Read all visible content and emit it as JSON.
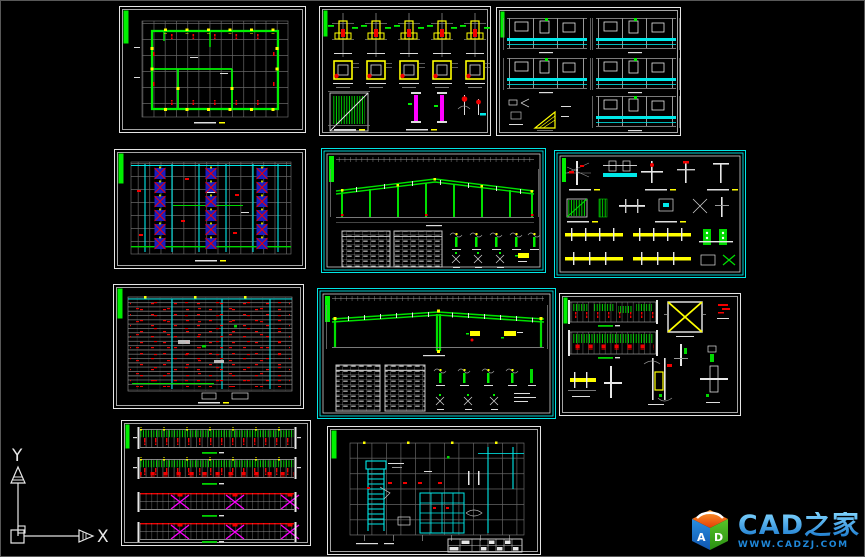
{
  "window": {
    "background": "#000000",
    "edge_border": "#585858"
  },
  "palette": {
    "green": "#00f000",
    "cyan": "#00e8e8",
    "red": "#f20000",
    "yellow": "#ffff00",
    "magenta": "#ff00ff",
    "blue": "#1d1dc0",
    "gray": "#8a8a8a",
    "white": "#e8e8e8",
    "frame_border": "#e6e6e6",
    "cyan_frame_border": "#00e5e5"
  },
  "ucs": {
    "x_label": "X",
    "y_label": "Y"
  },
  "logo": {
    "title": "CAD之家",
    "url": "WWW.CADZJ.COM",
    "cube_letter_left": "A",
    "cube_letter_right": "D",
    "text_color": "#2e9fe6"
  }
}
